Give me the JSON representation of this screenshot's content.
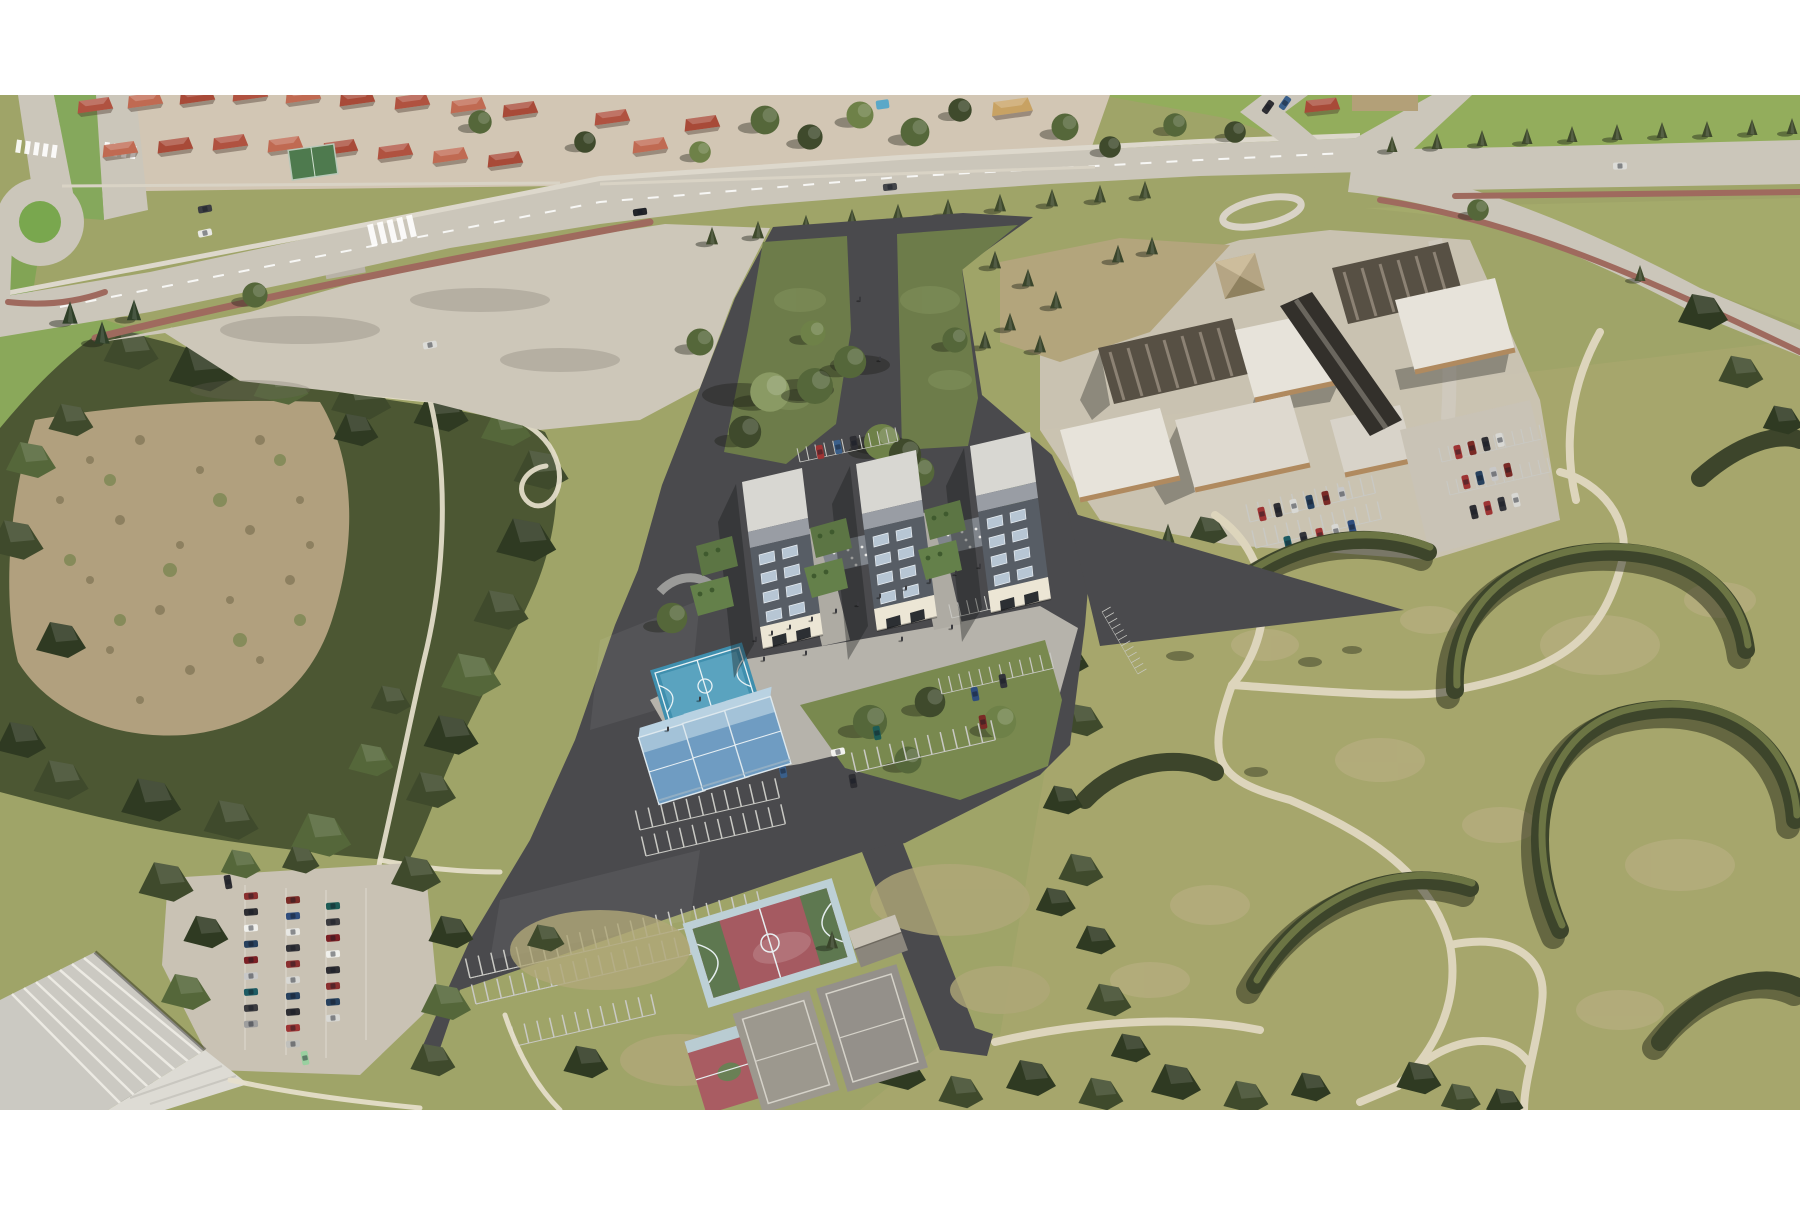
{
  "page": {
    "background_color": "#ffffff",
    "margins": {
      "top_band": true,
      "bottom_band": true
    }
  },
  "scene": {
    "kind": "aerial-3d-architectural-render",
    "view": "oblique aerial photograph with rendered development model overlay",
    "development_site": {
      "surface": "dark asphalt triangular parcel",
      "apartment_towers": 3,
      "tower_style": "cream base, dark pitched roof with skylights, light flat roof block",
      "green_courtyards": 2,
      "entry_green": "triangular lawn with forked footpaths and trees",
      "basketball_courts_new": 1,
      "padel_courts": 3,
      "striped_parking_rows": 6,
      "pedestrians_on_plaza": true
    },
    "context": {
      "residential_houses_red_roofs": 20,
      "roundabout": 1,
      "main_road_with_cycle_path": true,
      "roadside_conifers": true,
      "vacant_paved_lot": true,
      "red_roof_shed_by_road": 1,
      "industrial_complex": "sawtooth and white flat roofs with central dark arched hall",
      "industrial_parking_lots": 2,
      "public_park": "lawn with crescent hedgerows and winding footpaths",
      "woodland_belt_around_dry_scrub_field": true,
      "existing_red_basketball_court": 1,
      "existing_small_red_court": 1,
      "existing_grey_tennis_courts": 2,
      "court_shed": 1,
      "sports_hall_bottom_left": 1,
      "full_car_park_bottom_left": true
    },
    "palette": {
      "margin_white": "#ffffff",
      "road": "#cbc6ba",
      "site_asphalt": "#4a4a4d",
      "model_green": "#6d7c4a",
      "model_lawn": "#79894f",
      "plaza": "#b6b3ab",
      "base_grass": "#9fa468",
      "bright_lawn": "#93ad5c",
      "park_grass": "#a6a66c",
      "dry_field": "#b1a07e",
      "woodland": "#4c5733",
      "hedge": "#3d452b",
      "footpath": "#ddd5bc",
      "cycle_path_red": "#9f6a5e",
      "blue_court": "#4f9ab8",
      "padel_blue": "#6f9cc2",
      "red_court": "#a55a61",
      "grey_court": "#9c988e",
      "house_roof": "#b05240",
      "tower_flat_roof": "#d8d7d2",
      "tower_dark_roof": "#575d65",
      "tower_wall_cream": "#ece6d5",
      "industrial_roof_dark": "#575044",
      "industrial_roof_white": "#e7e3da",
      "brick": "#b08a5f"
    }
  }
}
